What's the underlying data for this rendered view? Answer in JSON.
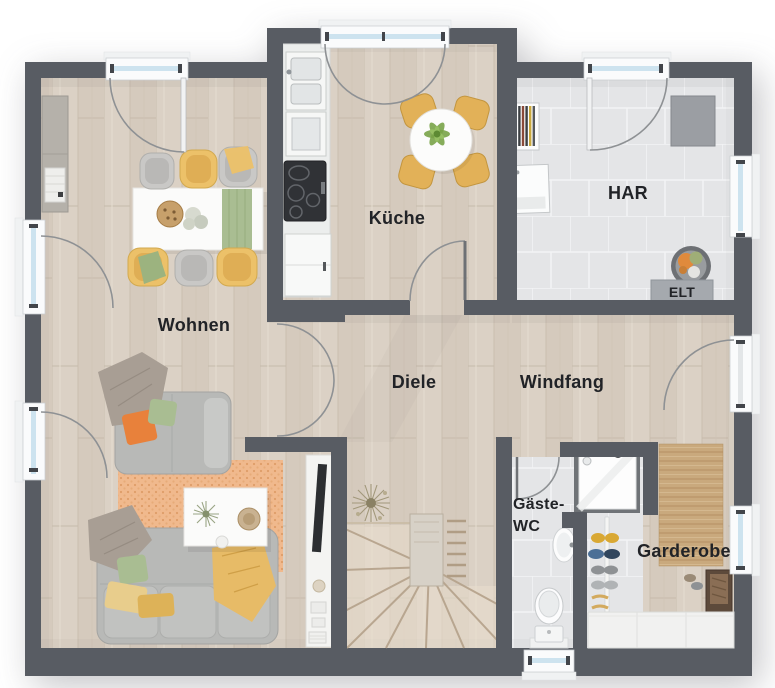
{
  "plan": {
    "rooms": {
      "wohnen": {
        "label": "Wohnen"
      },
      "kueche": {
        "label": "Küche"
      },
      "har": {
        "label": "HAR"
      },
      "diele": {
        "label": "Diele"
      },
      "windfang": {
        "label": "Windfang"
      },
      "gaeste_wc": {
        "label_line1": "Gäste-",
        "label_line2": "WC"
      },
      "garderobe": {
        "label": "Garderobe"
      }
    },
    "annotations": {
      "elt": {
        "label": "ELT"
      }
    },
    "colors": {
      "wall": "#585c63",
      "floor_wood": "#d9cfc3",
      "floor_tile": "#e4e5e7",
      "window_glass": "#cde3ef",
      "door_swing": "#8e9194",
      "label_text": "#212327",
      "accent_orange": "#e8813b",
      "accent_green": "#a9bd92",
      "accent_yellow": "#ecc169",
      "rug_terracotta": "#f0b98d",
      "rug_jute": "#c9a97d",
      "sofa_gray": "#b8b9b7"
    }
  }
}
